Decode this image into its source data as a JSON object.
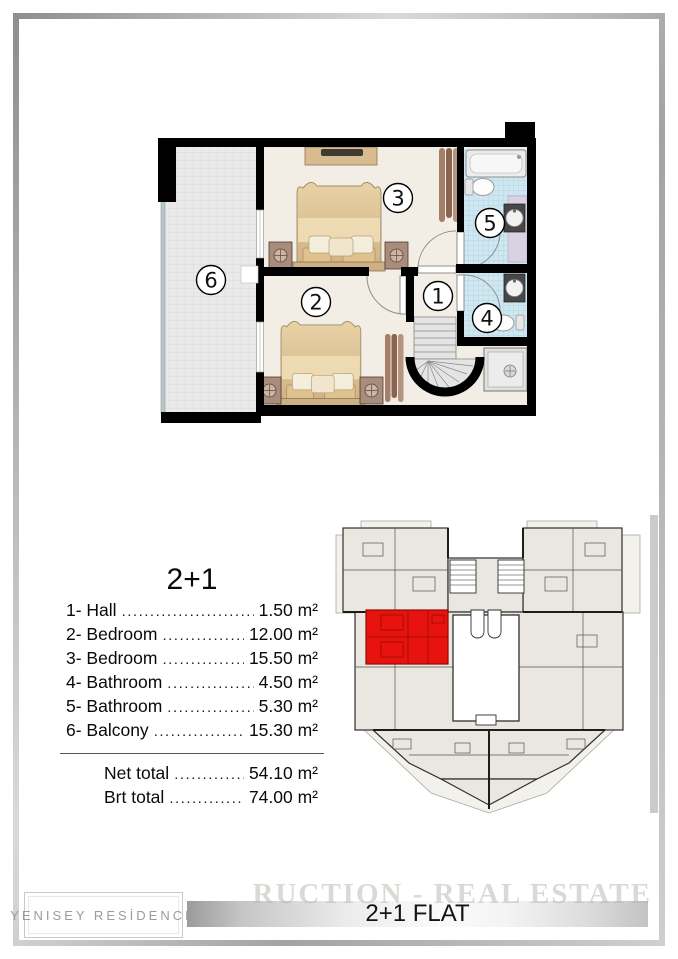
{
  "page": {
    "background": "#ffffff",
    "frame_color": "#a8a8a8"
  },
  "floor_plan": {
    "description": "2+1 flat floor plan",
    "room_numbers": [
      "1",
      "2",
      "3",
      "4",
      "5",
      "6"
    ],
    "colors": {
      "walls": "#000000",
      "bedroom_floor": "#f3eee5",
      "balcony_floor": "#eaeaea",
      "bathroom_tile": "#cfe7f1",
      "bed": "#ddc296",
      "curtain": "#8a6450",
      "stairs": "#e4e4e4"
    }
  },
  "legend": {
    "title": "2+1",
    "items": [
      {
        "label": "1- Hall",
        "value": "1.50 m²"
      },
      {
        "label": "2- Bedroom",
        "value": "12.00 m²"
      },
      {
        "label": "3- Bedroom",
        "value": "15.50 m²"
      },
      {
        "label": "4- Bathroom",
        "value": "4.50 m²"
      },
      {
        "label": "5- Bathroom",
        "value": "5.30 m²"
      },
      {
        "label": "6- Balcony",
        "value": "15.30 m²"
      }
    ],
    "totals": [
      {
        "label": "Net total",
        "value": "54.10 m²"
      },
      {
        "label": "Brt total",
        "value": "74.00 m²"
      }
    ]
  },
  "site_plan": {
    "description": "building level overview with highlighted flat",
    "highlight_color": "#e8120e",
    "building_fill": "#eae7e0"
  },
  "footer": {
    "residence_name": "YENISEY RESİDENCE",
    "flat_label": "2+1 FLAT",
    "watermark_text": "RUCTION - REAL ESTATE"
  }
}
